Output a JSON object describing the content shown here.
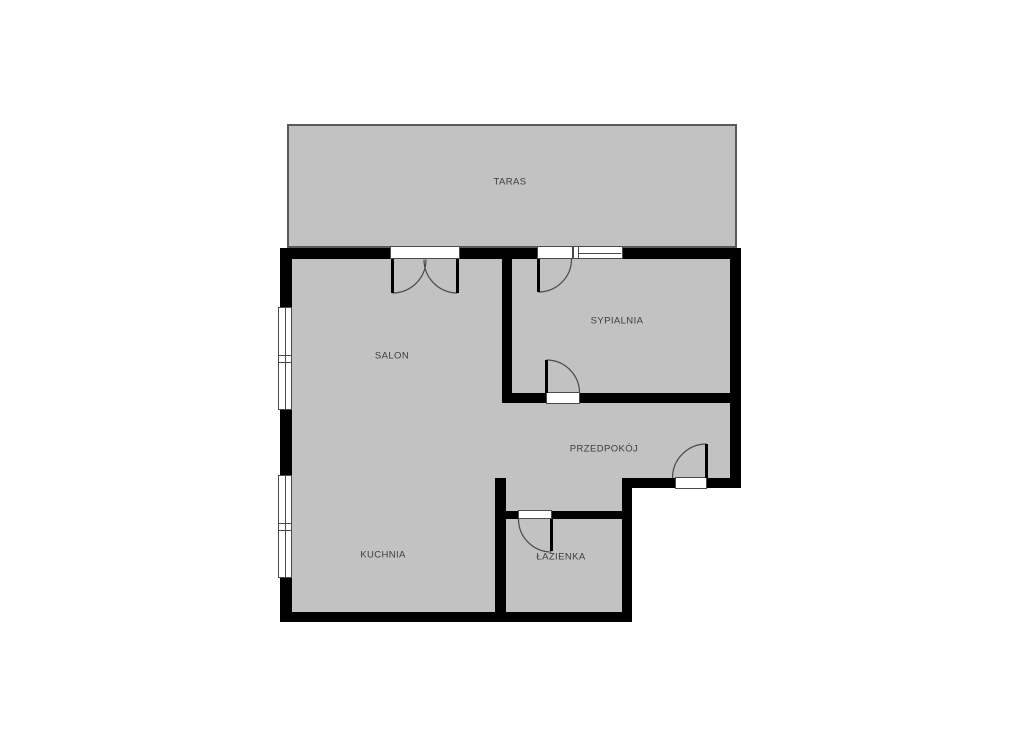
{
  "plan": {
    "type": "floor-plan",
    "colors": {
      "floor": "#c2c2c2",
      "wall": "#000000",
      "line": "#4a4a4a",
      "label": "#3d3d3d",
      "background": "#ffffff",
      "terrace_border": "#595959"
    },
    "rooms": [
      {
        "id": "taras",
        "label": "TARAS"
      },
      {
        "id": "salon",
        "label": "SALON"
      },
      {
        "id": "sypialnia",
        "label": "SYPIALNIA"
      },
      {
        "id": "przedpokoj",
        "label": "PRZEDPOKÓJ"
      },
      {
        "id": "kuchnia",
        "label": "KUCHNIA"
      },
      {
        "id": "lazienka",
        "label": "ŁAZIENKA"
      }
    ]
  }
}
